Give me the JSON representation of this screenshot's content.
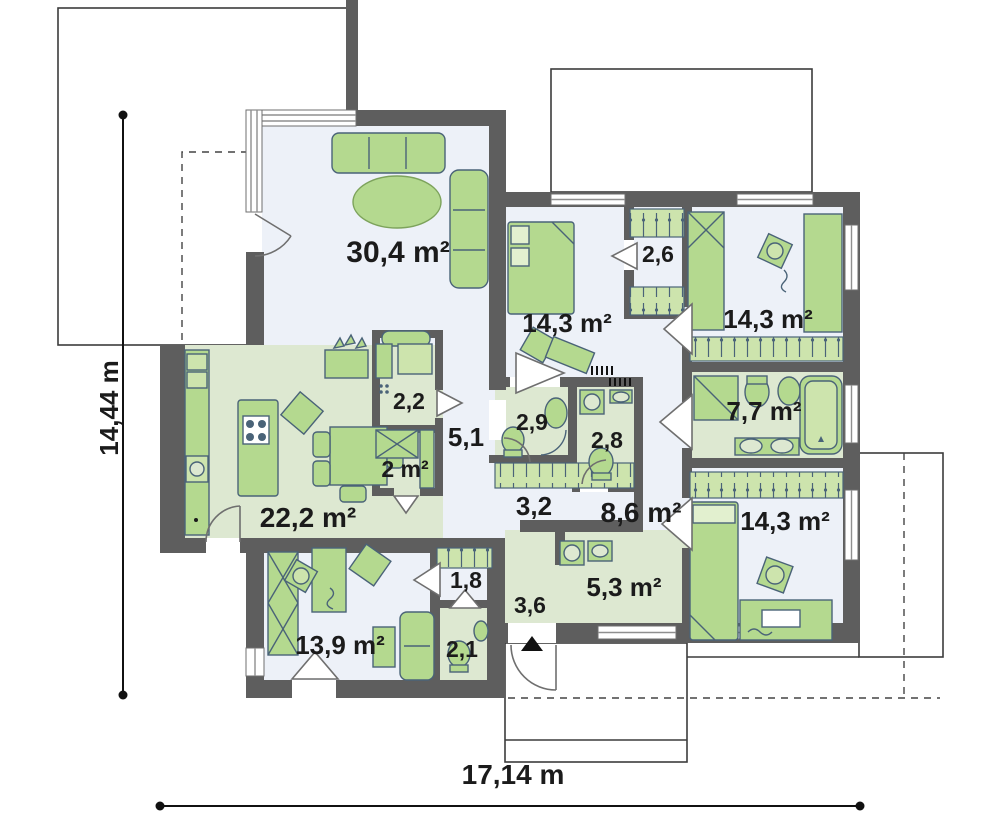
{
  "plan": {
    "width_dimension": "17,14 m",
    "height_dimension": "14,44 m"
  },
  "rooms": {
    "living_room": "30,4 m²",
    "kitchen_dining": "22,2 m²",
    "pantry": "2,2",
    "hall_center": "5,1",
    "closet": "2 m²",
    "bedroom_top_middle": "14,3 m²",
    "wardrobe_top": "2,6",
    "bedroom_top_right": "14,3 m²",
    "bathroom_small": "2,9",
    "wc_middle": "2,8",
    "corridor": "3,2",
    "hallway": "8,6 m²",
    "bathroom_main": "7,7 m²",
    "bedroom_bottom_right": "14,3 m²",
    "room_bottom_left": "13,9 m²",
    "wardrobe_bottom": "1,8",
    "wc_bottom": "2,1",
    "vestibule": "3,6",
    "utility": "5,3 m²"
  },
  "colors": {
    "wall": "#5e5e5e",
    "floor": "#edf1f8",
    "floor_accent": "#dde8d1",
    "furniture": "#b4d98f",
    "furniture_outline": "#4a6378",
    "wardrobe_strip": "#cde4ad",
    "label": "#1b1b1b"
  }
}
